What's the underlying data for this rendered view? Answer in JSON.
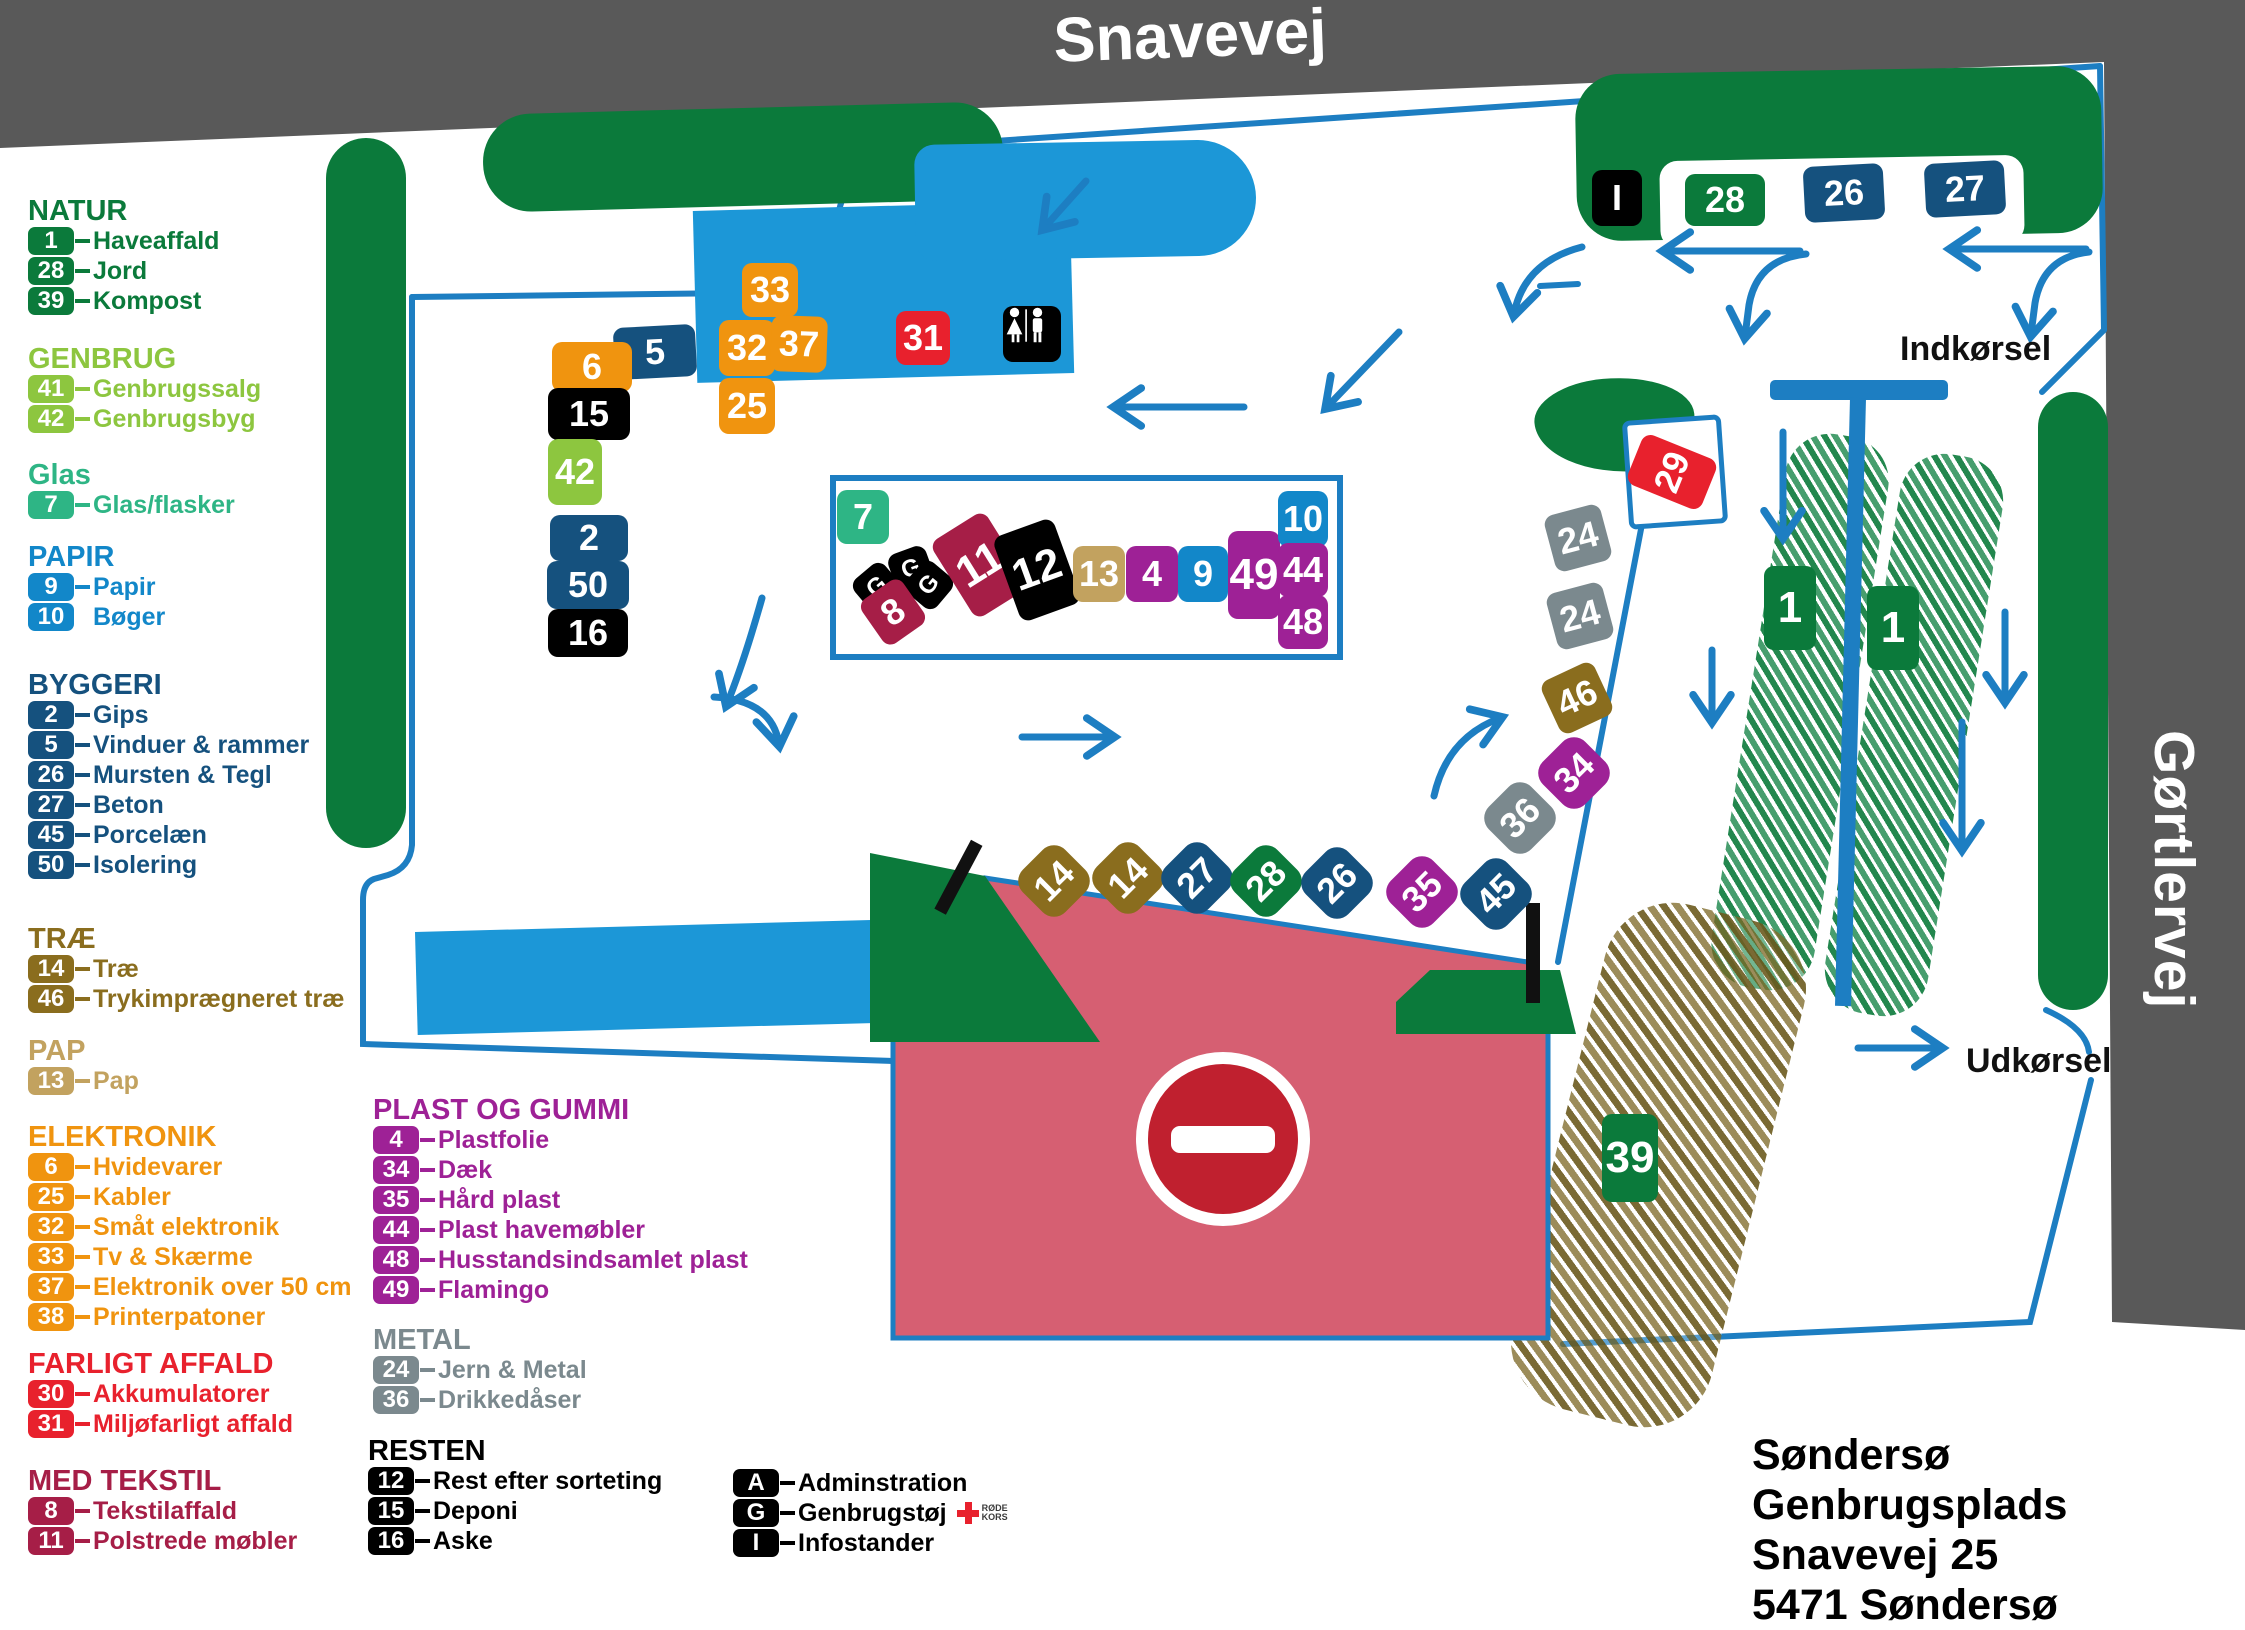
{
  "title": {
    "road_top": "Snavevej",
    "road_right": "Gørtlervej",
    "entrance": "Indkørsel",
    "exit": "Udkørsel"
  },
  "address": {
    "line1": "Søndersø Genbrugsplads",
    "line2": "Snavevej 25",
    "line3": "5471 Søndersø"
  },
  "red_cross": {
    "line1": "RØDE",
    "line2": "KORS"
  },
  "colors": {
    "dgreen": "#0b7a3b",
    "lgreen": "#8dc63f",
    "teal": "#2eb585",
    "blue": "#1287c9",
    "navy": "#15517e",
    "brown": "#8a6d1e",
    "tan": "#c2a25f",
    "orange": "#f0940f",
    "red": "#e8212d",
    "maroon": "#a61e47",
    "purple": "#9e2196",
    "gray": "#7b898e",
    "black": "#000000",
    "fence": "#1d7ec2",
    "road": "#595959",
    "pink": "#d65f72",
    "building": "#1c97d7",
    "sign_red": "#c0202f"
  },
  "legend": {
    "sections": [
      {
        "key": "natur",
        "title": "NATUR",
        "color": "dgreen",
        "items": [
          {
            "n": "1",
            "label": "Haveaffald",
            "dash": true
          },
          {
            "n": "28",
            "label": "Jord",
            "dash": true
          },
          {
            "n": "39",
            "label": "Kompost",
            "dash": true
          }
        ]
      },
      {
        "key": "genbrug",
        "title": "GENBRUG",
        "color": "lgreen",
        "items": [
          {
            "n": "41",
            "label": "Genbrugssalg",
            "dash": true
          },
          {
            "n": "42",
            "label": "Genbrugsbyg",
            "dash": true
          }
        ]
      },
      {
        "key": "glas",
        "title": "Glas",
        "color": "teal",
        "items": [
          {
            "n": "7",
            "label": "Glas/flasker",
            "dash": true
          }
        ]
      },
      {
        "key": "papir",
        "title": "PAPIR",
        "color": "blue",
        "items": [
          {
            "n": "9",
            "label": "Papir",
            "dash": true
          },
          {
            "n": "10",
            "label": "Bøger",
            "dash": false
          }
        ]
      },
      {
        "key": "byggeri",
        "title": "BYGGERI",
        "color": "navy",
        "items": [
          {
            "n": "2",
            "label": "Gips",
            "dash": true
          },
          {
            "n": "5",
            "label": "Vinduer & rammer",
            "dash": true
          },
          {
            "n": "26",
            "label": "Mursten & Tegl",
            "dash": true
          },
          {
            "n": "27",
            "label": "Beton",
            "dash": true
          },
          {
            "n": "45",
            "label": "Porcelæn",
            "dash": true
          },
          {
            "n": "50",
            "label": "Isolering",
            "dash": true
          }
        ]
      },
      {
        "key": "trae",
        "title": "TRÆ",
        "color": "brown",
        "items": [
          {
            "n": "14",
            "label": "Træ",
            "dash": true
          },
          {
            "n": "46",
            "label": "Trykimprægneret træ",
            "dash": true
          }
        ]
      },
      {
        "key": "pap",
        "title": "PAP",
        "color": "tan",
        "items": [
          {
            "n": "13",
            "label": "Pap",
            "dash": true
          }
        ]
      },
      {
        "key": "elektronik",
        "title": "ELEKTRONIK",
        "color": "orange",
        "items": [
          {
            "n": "6",
            "label": "Hvidevarer",
            "dash": true
          },
          {
            "n": "25",
            "label": "Kabler",
            "dash": true
          },
          {
            "n": "32",
            "label": "Småt elektronik",
            "dash": true
          },
          {
            "n": "33",
            "label": "Tv & Skærme",
            "dash": true
          },
          {
            "n": "37",
            "label": "Elektronik over 50 cm",
            "dash": true
          },
          {
            "n": "38",
            "label": "Printerpatoner",
            "dash": true
          }
        ]
      },
      {
        "key": "farligt",
        "title": "FARLIGT AFFALD",
        "color": "red",
        "items": [
          {
            "n": "30",
            "label": "Akkumulatorer",
            "dash": true
          },
          {
            "n": "31",
            "label": "Miljøfarligt affald",
            "dash": true
          }
        ]
      },
      {
        "key": "tekstil",
        "title": "MED TEKSTIL",
        "color": "maroon",
        "items": [
          {
            "n": "8",
            "label": "Tekstilaffald",
            "dash": true
          },
          {
            "n": "11",
            "label": "Polstrede møbler",
            "dash": true
          }
        ]
      },
      {
        "key": "plast",
        "title": "PLAST OG GUMMI",
        "color": "purple",
        "items": [
          {
            "n": "4",
            "label": "Plastfolie",
            "dash": true
          },
          {
            "n": "34",
            "label": "Dæk",
            "dash": true
          },
          {
            "n": "35",
            "label": "Hård plast",
            "dash": true
          },
          {
            "n": "44",
            "label": "Plast havemøbler",
            "dash": true
          },
          {
            "n": "48",
            "label": "Husstandsindsamlet plast",
            "dash": true
          },
          {
            "n": "49",
            "label": "Flamingo",
            "dash": true
          }
        ]
      },
      {
        "key": "metal",
        "title": "METAL",
        "color": "gray",
        "items": [
          {
            "n": "24",
            "label": "Jern & Metal",
            "dash": true
          },
          {
            "n": "36",
            "label": "Drikkedåser",
            "dash": true
          }
        ]
      },
      {
        "key": "resten",
        "title": "RESTEN",
        "color": "black",
        "items": [
          {
            "n": "12",
            "label": "Rest efter sorteting",
            "dash": true
          },
          {
            "n": "15",
            "label": "Deponi",
            "dash": true
          },
          {
            "n": "16",
            "label": "Aske",
            "dash": true
          }
        ]
      },
      {
        "key": "admin",
        "title": "",
        "color": "black",
        "items": [
          {
            "n": "A",
            "label": "Adminstration",
            "dash": true
          },
          {
            "n": "G",
            "label": "Genbrugstøj",
            "dash": true,
            "cross": true
          },
          {
            "n": "I",
            "label": "Infostander",
            "dash": true
          }
        ]
      }
    ]
  },
  "map": {
    "tags": [
      {
        "t": "5",
        "c": "navy",
        "x": 655,
        "y": 352,
        "w": 82,
        "h": 52,
        "r": -3
      },
      {
        "t": "33",
        "c": "orange",
        "x": 770,
        "y": 290,
        "w": 56,
        "h": 54,
        "r": 0
      },
      {
        "t": "32",
        "c": "orange",
        "x": 747,
        "y": 348,
        "w": 56,
        "h": 56,
        "r": 0
      },
      {
        "t": "37",
        "c": "orange",
        "x": 799,
        "y": 344,
        "w": 56,
        "h": 56,
        "r": 2
      },
      {
        "t": "25",
        "c": "orange",
        "x": 747,
        "y": 406,
        "w": 56,
        "h": 56,
        "r": 0
      },
      {
        "t": "31",
        "c": "red",
        "x": 923,
        "y": 338,
        "w": 54,
        "h": 54,
        "r": 0
      },
      {
        "t": "WC",
        "c": "black",
        "x": 1032,
        "y": 334,
        "w": 58,
        "h": 56,
        "r": 0,
        "icon": "restroom"
      },
      {
        "t": "6",
        "c": "orange",
        "x": 592,
        "y": 367,
        "w": 80,
        "h": 50,
        "r": 0
      },
      {
        "t": "15",
        "c": "black",
        "x": 589,
        "y": 414,
        "w": 82,
        "h": 52,
        "r": 0
      },
      {
        "t": "42",
        "c": "lgreen",
        "x": 575,
        "y": 472,
        "w": 54,
        "h": 66,
        "r": 0
      },
      {
        "t": "2",
        "c": "navy",
        "x": 589,
        "y": 538,
        "w": 78,
        "h": 46,
        "r": 0
      },
      {
        "t": "50",
        "c": "navy",
        "x": 588,
        "y": 585,
        "w": 82,
        "h": 48,
        "r": 0
      },
      {
        "t": "16",
        "c": "black",
        "x": 588,
        "y": 633,
        "w": 80,
        "h": 48,
        "r": 0
      },
      {
        "t": "7",
        "c": "teal",
        "x": 863,
        "y": 517,
        "w": 52,
        "h": 54,
        "r": 0
      },
      {
        "t": "G",
        "c": "black",
        "x": 877,
        "y": 587,
        "w": 40,
        "h": 40,
        "r": -40
      },
      {
        "t": "G",
        "c": "black",
        "x": 911,
        "y": 569,
        "w": 40,
        "h": 40,
        "r": -20
      },
      {
        "t": "G",
        "c": "black",
        "x": 929,
        "y": 585,
        "w": 40,
        "h": 40,
        "r": -50
      },
      {
        "t": "8",
        "c": "maroon",
        "x": 893,
        "y": 612,
        "w": 50,
        "h": 54,
        "r": -35
      },
      {
        "t": "11",
        "c": "maroon",
        "x": 980,
        "y": 565,
        "w": 64,
        "h": 90,
        "r": -32
      },
      {
        "t": "12",
        "c": "black",
        "x": 1037,
        "y": 570,
        "w": 64,
        "h": 90,
        "r": -20
      },
      {
        "t": "13",
        "c": "tan",
        "x": 1099,
        "y": 574,
        "w": 52,
        "h": 56,
        "r": 0
      },
      {
        "t": "4",
        "c": "purple",
        "x": 1152,
        "y": 574,
        "w": 52,
        "h": 56,
        "r": 0
      },
      {
        "t": "9",
        "c": "blue",
        "x": 1203,
        "y": 574,
        "w": 50,
        "h": 56,
        "r": 0
      },
      {
        "t": "49",
        "c": "purple",
        "x": 1254,
        "y": 575,
        "w": 52,
        "h": 88,
        "r": 0
      },
      {
        "t": "10",
        "c": "blue",
        "x": 1303,
        "y": 519,
        "w": 50,
        "h": 56,
        "r": 0
      },
      {
        "t": "44",
        "c": "purple",
        "x": 1303,
        "y": 570,
        "w": 50,
        "h": 54,
        "r": 0
      },
      {
        "t": "48",
        "c": "purple",
        "x": 1303,
        "y": 622,
        "w": 50,
        "h": 54,
        "r": 0
      },
      {
        "t": "14",
        "c": "brown",
        "x": 1054,
        "y": 881,
        "w": 60,
        "h": 60,
        "r": -45,
        "shape": "d"
      },
      {
        "t": "14",
        "c": "brown",
        "x": 1128,
        "y": 878,
        "w": 60,
        "h": 60,
        "r": -45,
        "shape": "d"
      },
      {
        "t": "27",
        "c": "navy",
        "x": 1197,
        "y": 878,
        "w": 60,
        "h": 60,
        "r": -45,
        "shape": "d"
      },
      {
        "t": "28",
        "c": "dgreen",
        "x": 1266,
        "y": 881,
        "w": 60,
        "h": 60,
        "r": -45,
        "shape": "d"
      },
      {
        "t": "26",
        "c": "navy",
        "x": 1337,
        "y": 883,
        "w": 60,
        "h": 60,
        "r": -45,
        "shape": "d"
      },
      {
        "t": "35",
        "c": "purple",
        "x": 1422,
        "y": 892,
        "w": 60,
        "h": 60,
        "r": -45,
        "shape": "d"
      },
      {
        "t": "45",
        "c": "navy",
        "x": 1496,
        "y": 894,
        "w": 60,
        "h": 60,
        "r": -45,
        "shape": "d"
      },
      {
        "t": "36",
        "c": "gray",
        "x": 1520,
        "y": 818,
        "w": 60,
        "h": 60,
        "r": -45,
        "shape": "d"
      },
      {
        "t": "34",
        "c": "purple",
        "x": 1574,
        "y": 773,
        "w": 60,
        "h": 60,
        "r": -45,
        "shape": "d"
      },
      {
        "t": "46",
        "c": "brown",
        "x": 1577,
        "y": 698,
        "w": 58,
        "h": 58,
        "r": -25
      },
      {
        "t": "24",
        "c": "gray",
        "x": 1580,
        "y": 616,
        "w": 58,
        "h": 58,
        "r": -15
      },
      {
        "t": "24",
        "c": "gray",
        "x": 1578,
        "y": 538,
        "w": 58,
        "h": 58,
        "r": -15
      },
      {
        "t": "29",
        "c": "red",
        "x": 1672,
        "y": 472,
        "w": 54,
        "h": 80,
        "r": -68
      },
      {
        "t": "39",
        "c": "dgreen",
        "x": 1630,
        "y": 1158,
        "w": 56,
        "h": 88,
        "r": 0
      },
      {
        "t": "I",
        "c": "black",
        "x": 1617,
        "y": 198,
        "w": 50,
        "h": 56,
        "r": 0
      },
      {
        "t": "28",
        "c": "dgreen",
        "x": 1725,
        "y": 200,
        "w": 80,
        "h": 52,
        "r": 0
      },
      {
        "t": "26",
        "c": "navy",
        "x": 1844,
        "y": 193,
        "w": 80,
        "h": 56,
        "r": -3
      },
      {
        "t": "27",
        "c": "navy",
        "x": 1965,
        "y": 189,
        "w": 80,
        "h": 54,
        "r": -3
      },
      {
        "t": "1",
        "c": "dgreen",
        "x": 1790,
        "y": 608,
        "w": 52,
        "h": 84,
        "r": 0
      },
      {
        "t": "1",
        "c": "dgreen",
        "x": 1893,
        "y": 628,
        "w": 52,
        "h": 84,
        "r": 0
      }
    ]
  }
}
